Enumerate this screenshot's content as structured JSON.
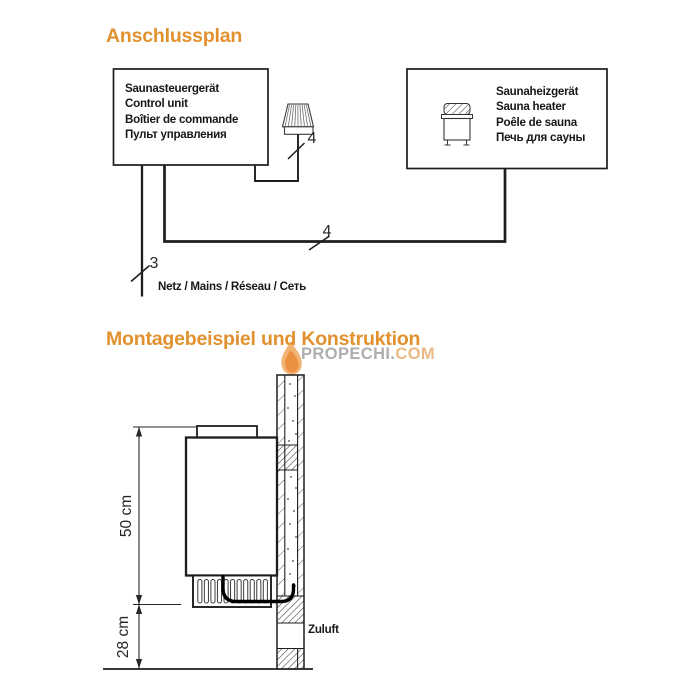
{
  "colors": {
    "accent_orange": "#e2912f",
    "line_black": "#1d1d1b",
    "watermark_gray": "#7e7e7e",
    "watermark_orange": "#e0913a"
  },
  "connection": {
    "title": "Anschlussplan",
    "control_unit": {
      "lines": [
        "Saunasteuergerät",
        "Control unit",
        "Boîtier de commande",
        "Пульт управления"
      ]
    },
    "heater_unit": {
      "lines": [
        "Saunaheizgerät",
        "Sauna heater",
        "Poêle de sauna",
        "Печь для сауны"
      ]
    },
    "cable_numbers": {
      "mains_cable": "3",
      "light_cable": "4",
      "heater_cable": "4"
    },
    "mains_label": "Netz / Mains / Réseau / Сеть"
  },
  "installation": {
    "title": "Montagebeispiel und Konstruktion",
    "height_dimension": "50 cm",
    "floor_dimension": "28 cm",
    "air_supply_label": "Zuluft"
  },
  "watermark": {
    "part_gray": "PROPECHI.",
    "part_orange": "COM"
  }
}
